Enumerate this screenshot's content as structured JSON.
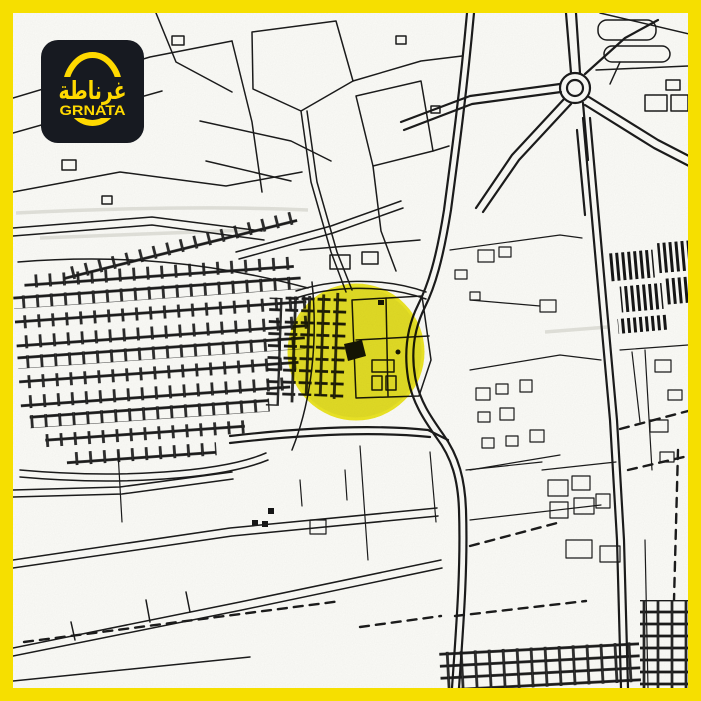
{
  "frame": {
    "border_color": "#F6DF00"
  },
  "logo": {
    "background_color": "#171A21",
    "accent_color": "#FFD900",
    "arabic_text": "غرناطة",
    "latin_text": "GRNATA"
  },
  "map": {
    "paper_color": "#FBFBF7",
    "line_color": "#1B1B1B",
    "highlight_color": "#DFD900",
    "highlight_rim_color": "#EDE400"
  }
}
